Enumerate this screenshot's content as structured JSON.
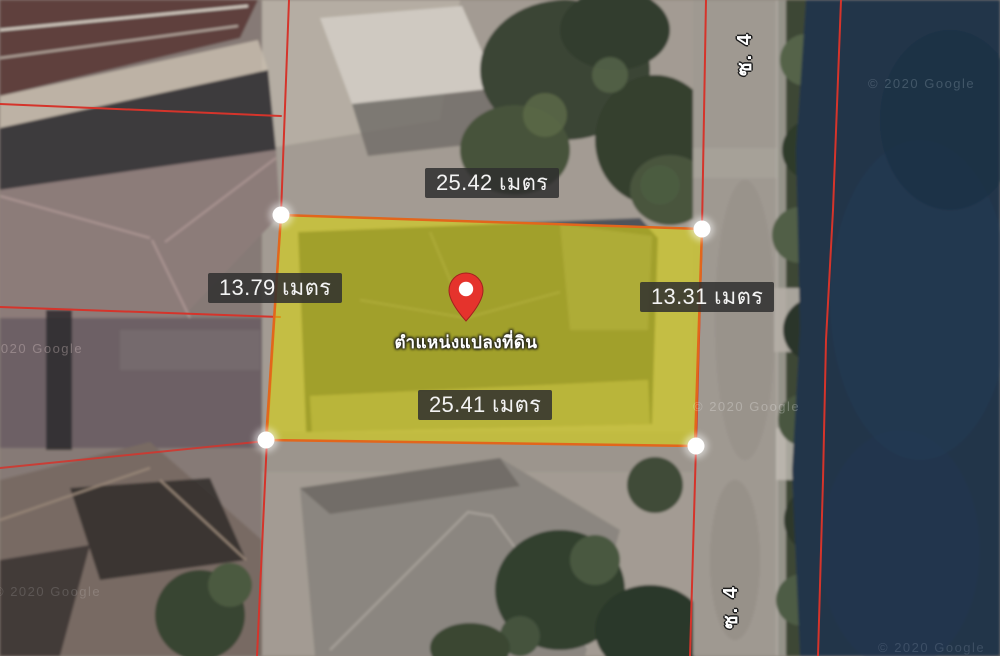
{
  "map": {
    "watermark": "© 2020 Google",
    "road_label": "ซ. 4"
  },
  "plot": {
    "pin_label": "ตำแหน่งแปลงที่ดิน",
    "measurements": {
      "top": "25.42 เมตร",
      "left": "13.79 เมตร",
      "right": "13.31 เมตร",
      "bottom": "25.41 เมตร"
    }
  },
  "colors": {
    "plot_fill": "#ddd80b",
    "plot_stroke": "#e2661c",
    "boundary_red": "#d5342b",
    "water": "#203449",
    "road": "#9f9991",
    "label_bg": "rgba(47,47,47,0.85)",
    "pin_red": "#e5332c",
    "marker_white": "#ffffff"
  }
}
